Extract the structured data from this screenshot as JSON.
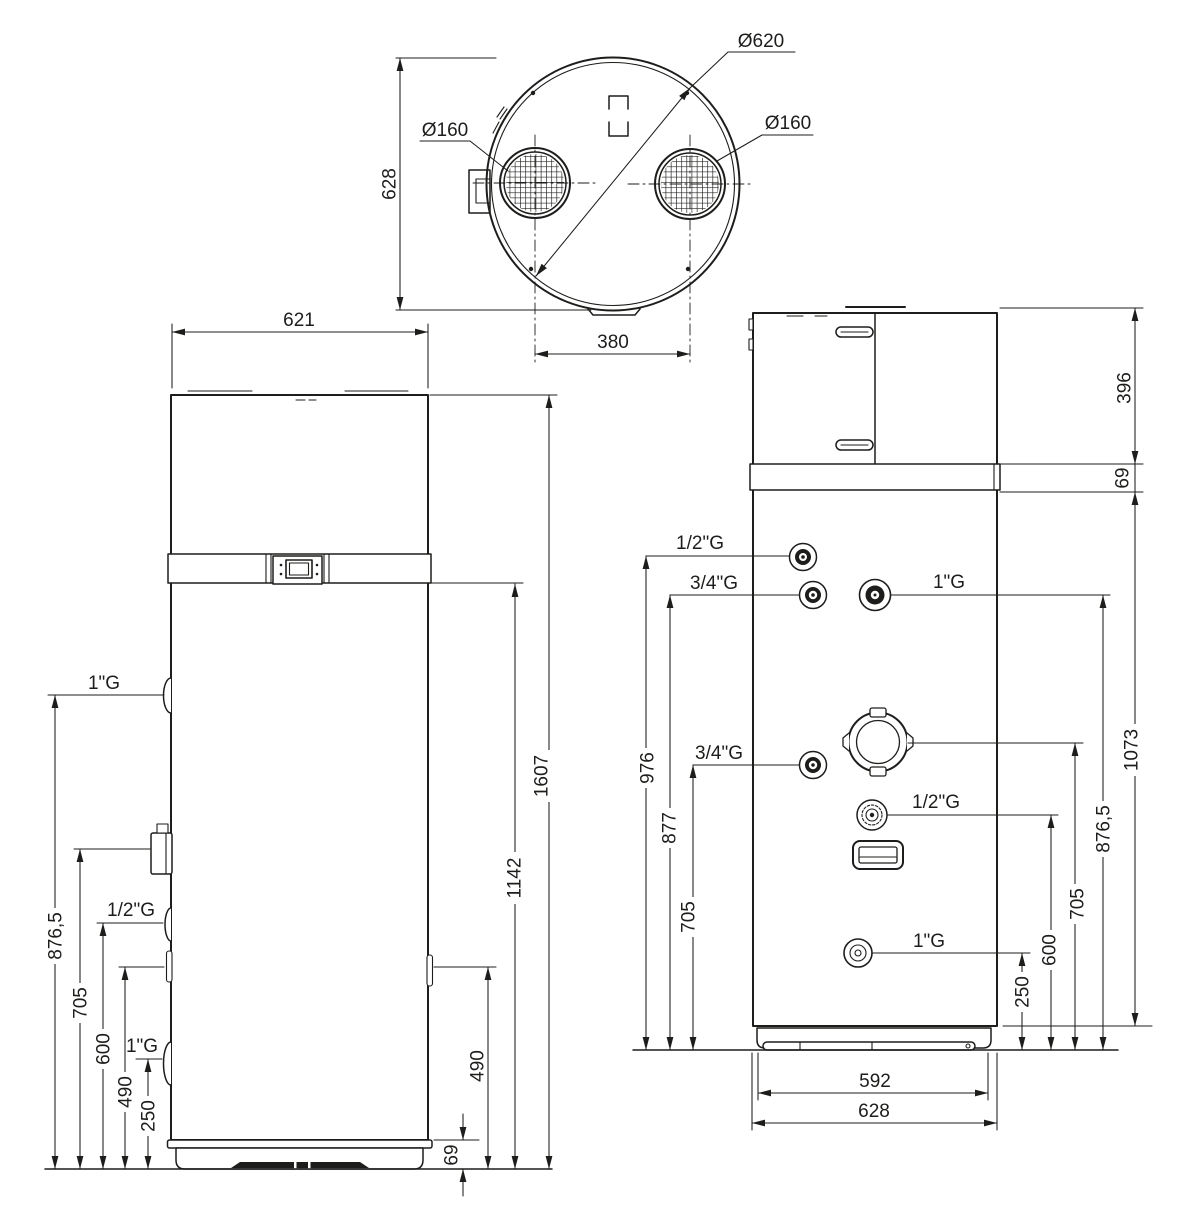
{
  "meta": {
    "ink": "#1d1d1b",
    "paper": "#ffffff"
  },
  "top_view": {
    "dims": {
      "shell_diameter": "Ø620",
      "fan_diameter_left": "Ø160",
      "fan_diameter_right": "Ø160",
      "depth": "628",
      "fan_spacing": "380"
    }
  },
  "side_view": {
    "dims": {
      "width": "621",
      "left": [
        "876,5",
        "705",
        "600",
        "490",
        "250"
      ],
      "right": [
        "69",
        "490",
        "1142",
        "1607"
      ]
    },
    "ports": [
      {
        "label": "1\"G"
      },
      {
        "label": "1/2\"G"
      },
      {
        "label": "1\"G"
      }
    ]
  },
  "front_view": {
    "dims": {
      "stack": [
        "396",
        "69",
        "1073"
      ],
      "left": [
        "976",
        "877",
        "705"
      ],
      "right": [
        "250",
        "600",
        "705",
        "876,5"
      ],
      "base_width": "592",
      "overall_width": "628"
    },
    "ports": [
      {
        "label": "1/2\"G"
      },
      {
        "label": "3/4\"G"
      },
      {
        "label": "1\"G"
      },
      {
        "label": "3/4\"G"
      },
      {
        "label": "1/2\"G"
      },
      {
        "label": "1\"G"
      }
    ]
  }
}
